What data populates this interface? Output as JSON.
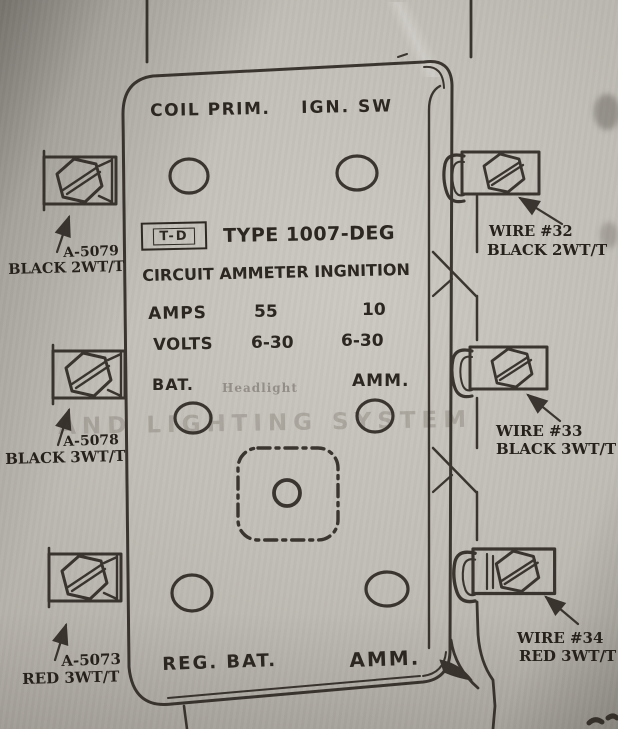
{
  "device": {
    "terminal_top_left": "COIL PRIM.",
    "terminal_top_right": "IGN. SW",
    "brand_badge": "T-D",
    "type": "TYPE 1007-DEG",
    "subtitle": "CIRCUIT AMMETER INGNITION",
    "specs": {
      "amps_label": "AMPS",
      "amps_col1": "55",
      "amps_col2": "10",
      "volts_label": "VOLTS",
      "volts_col1": "6-30",
      "volts_col2": "6-30"
    },
    "terminal_mid_left": "BAT.",
    "terminal_mid_right": "AMM.",
    "terminal_bottom_left": "REG. BAT.",
    "terminal_bottom_right": "AMM."
  },
  "wires": {
    "left": [
      {
        "part": "A-5079",
        "spec": "BLACK 2WT/T"
      },
      {
        "part": "A-5078",
        "spec": "BLACK 3WT/T"
      },
      {
        "part": "A-5073",
        "spec": "RED 3WT/T"
      }
    ],
    "right": [
      {
        "part": "WIRE #32",
        "spec": "BLACK 2WT/T"
      },
      {
        "part": "WIRE #33",
        "spec": "BLACK 3WT/T"
      },
      {
        "part": "WIRE #34",
        "spec": "RED 3WT/T"
      }
    ]
  },
  "bleed_through": {
    "line1": "Headlight",
    "line2": "AND LIGHTING SYSTEM"
  },
  "colors": {
    "ink": "#2e2923",
    "paper": "#c1beb7"
  }
}
